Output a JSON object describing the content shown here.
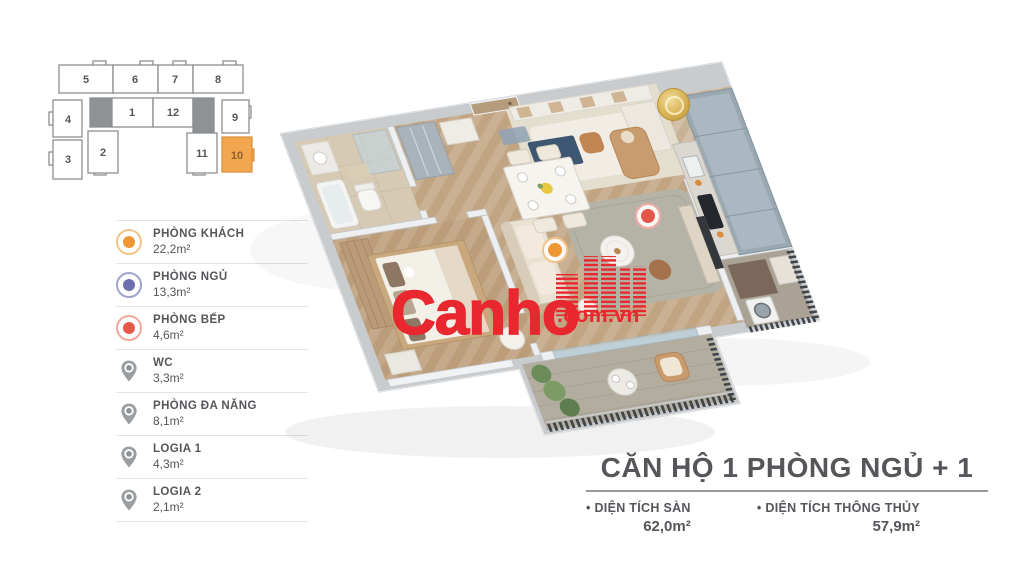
{
  "colors": {
    "accent_orange": "#EE9734",
    "accent_indigo": "#6A6FAE",
    "accent_red": "#E4584A",
    "pin_gray": "#9B9EA0",
    "watermark_red": "#E8282E",
    "text_dark": "#54565A",
    "highlighted_unit_fill": "#F2A74F"
  },
  "key_plan": {
    "units": [
      "5",
      "6",
      "7",
      "8",
      "4",
      "1",
      "12",
      "9",
      "3",
      "2",
      "11",
      "10"
    ],
    "highlighted_unit": "10"
  },
  "legend": {
    "items": [
      {
        "label": "PHÒNG KHÁCH",
        "area": "22,2m²",
        "icon": "circle-orange"
      },
      {
        "label": "PHÒNG NGỦ",
        "area": "13,3m²",
        "icon": "circle-indigo"
      },
      {
        "label": "PHÒNG BẾP",
        "area": "4,6m²",
        "icon": "circle-red"
      },
      {
        "label": "WC",
        "area": "3,3m²",
        "icon": "pin"
      },
      {
        "label": "PHÒNG ĐA NĂNG",
        "area": "8,1m²",
        "icon": "pin"
      },
      {
        "label": "LOGIA 1",
        "area": "4,3m²",
        "icon": "pin"
      },
      {
        "label": "LOGIA 2",
        "area": "2,1m²",
        "icon": "pin"
      }
    ]
  },
  "floor_plan": {
    "markers": [
      {
        "name": "living-room-marker",
        "color": "#EE9734"
      },
      {
        "name": "kitchen-marker",
        "color": "#E4584A"
      }
    ]
  },
  "watermark": {
    "brand": "Canho",
    "domain": ".com.vn"
  },
  "unit_info": {
    "title": "CĂN HỘ 1 PHÒNG NGỦ + 1",
    "bullet": "•",
    "stats": [
      {
        "label": "DIỆN TÍCH SÀN",
        "value": "62,0m²"
      },
      {
        "label": "DIỆN TÍCH THÔNG THỦY",
        "value": "57,9m²"
      }
    ]
  }
}
